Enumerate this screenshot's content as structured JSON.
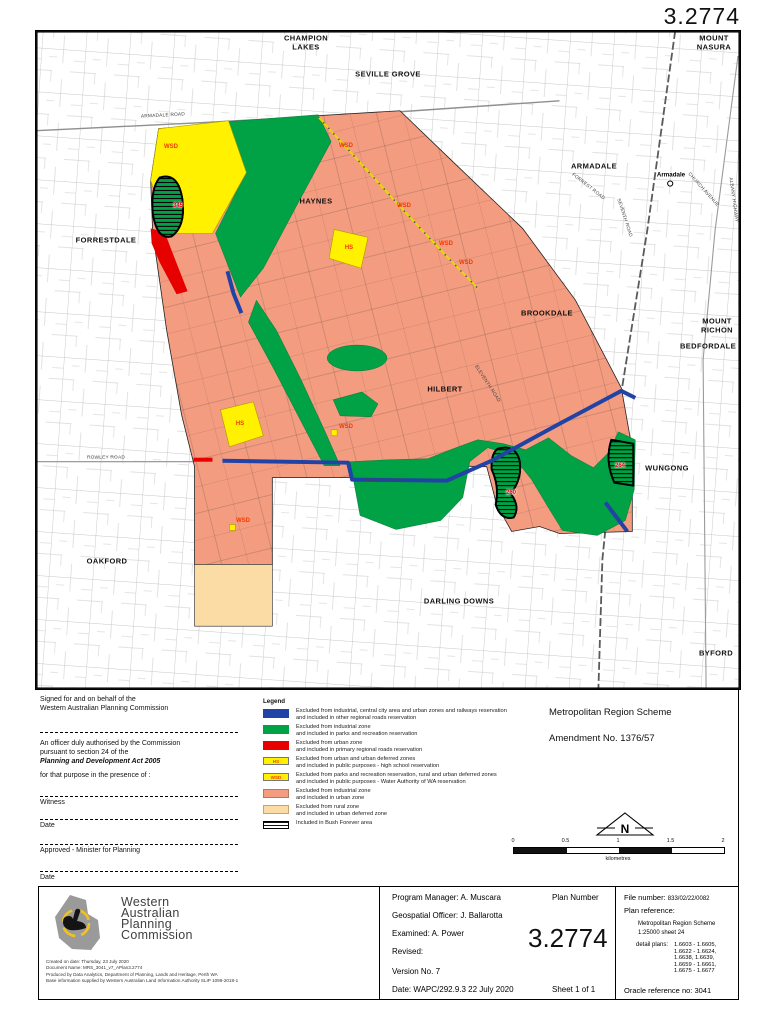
{
  "page": {
    "plan_number": "3.2774"
  },
  "map": {
    "colors": {
      "urban_salmon": "#F49C80",
      "parks_green": "#00A245",
      "reservation_yellow": "#FFF100",
      "roads_blue": "#2143A6",
      "roads_red": "#E60000",
      "urban_deferred_peach": "#FADCA4"
    },
    "suburbs": [
      {
        "t": "CHAMPION",
        "x": 306,
        "y": 38
      },
      {
        "t": "LAKES",
        "x": 306,
        "y": 47
      },
      {
        "t": "SEVILLE GROVE",
        "x": 388,
        "y": 74
      },
      {
        "t": "MOUNT",
        "x": 714,
        "y": 38
      },
      {
        "t": "NASURA",
        "x": 714,
        "y": 47
      },
      {
        "t": "ARMADALE",
        "x": 594,
        "y": 166
      },
      {
        "t": "FORRESTDALE",
        "x": 106,
        "y": 240
      },
      {
        "t": "HAYNES",
        "x": 316,
        "y": 201
      },
      {
        "t": "BROOKDALE",
        "x": 547,
        "y": 313
      },
      {
        "t": "MOUNT",
        "x": 717,
        "y": 321
      },
      {
        "t": "RICHON",
        "x": 717,
        "y": 330
      },
      {
        "t": "BEDFORDALE",
        "x": 708,
        "y": 346
      },
      {
        "t": "HILBERT",
        "x": 445,
        "y": 389
      },
      {
        "t": "WUNGONG",
        "x": 667,
        "y": 468
      },
      {
        "t": "OAKFORD",
        "x": 107,
        "y": 561
      },
      {
        "t": "DARLING DOWNS",
        "x": 459,
        "y": 601
      },
      {
        "t": "BYFORD",
        "x": 716,
        "y": 653
      }
    ],
    "roads": [
      {
        "t": "ARMADALE ROAD",
        "x": 163,
        "y": 116,
        "r": -3
      },
      {
        "t": "ROWLEY ROAD",
        "x": 106,
        "y": 458,
        "r": 0
      },
      {
        "t": "ROWLEY ROAD",
        "x": 385,
        "y": 481,
        "r": 0
      },
      {
        "t": "ELEVENTH ROAD",
        "x": 487,
        "y": 384,
        "r": 57
      },
      {
        "t": "SEVENTH ROAD",
        "x": 624,
        "y": 218,
        "r": 72
      },
      {
        "t": "FORREST ROAD",
        "x": 588,
        "y": 187,
        "r": 38
      },
      {
        "t": "CHURCH AVENUE",
        "x": 703,
        "y": 190,
        "r": 48
      },
      {
        "t": "ALBANY HIGHWAY",
        "x": 733,
        "y": 200,
        "r": 82
      }
    ],
    "reservations": [
      {
        "t": "WSD",
        "x": 171,
        "y": 147
      },
      {
        "t": "WSD",
        "x": 346,
        "y": 146
      },
      {
        "t": "WSD",
        "x": 404,
        "y": 206
      },
      {
        "t": "WSD",
        "x": 446,
        "y": 244
      },
      {
        "t": "WSD",
        "x": 466,
        "y": 263
      },
      {
        "t": "WSD",
        "x": 346,
        "y": 427
      },
      {
        "t": "WSD",
        "x": 243,
        "y": 521
      },
      {
        "t": "HS",
        "x": 349,
        "y": 248
      },
      {
        "t": "HS",
        "x": 240,
        "y": 424
      }
    ],
    "bush_forever": [
      {
        "t": "345",
        "x": 178,
        "y": 206
      },
      {
        "t": "260",
        "x": 511,
        "y": 493
      },
      {
        "t": "264",
        "x": 620,
        "y": 466
      }
    ],
    "station": {
      "t": "Armadale",
      "x": 671,
      "y": 175
    }
  },
  "signature": {
    "line1": "Signed for and on behalf of the",
    "line2": "Western Australian Planning Commission",
    "officer1": "An officer duly authorised by the Commission",
    "officer2": "pursuant to section 24 of the",
    "act": "Planning and Development Act 2005",
    "presence": "for that purpose in the presence of :",
    "witness": "Witness",
    "date1": "Date",
    "approved": "Approved - Minister for Planning",
    "date2": "Date"
  },
  "legend": {
    "title": "Legend",
    "items": [
      {
        "swatch": "blue",
        "lines": [
          "Excluded from industrial, central city area and urban zones and railways reservation",
          "and included in other regional roads reservation"
        ]
      },
      {
        "swatch": "green",
        "lines": [
          "Excluded from industrial zone",
          "and included in parks and recreation reservation"
        ]
      },
      {
        "swatch": "red",
        "lines": [
          "Excluded from urban zone",
          "and included in primary regional roads reservation"
        ]
      },
      {
        "swatch": "hs",
        "swatch_label": "HS",
        "lines": [
          "Excluded from urban and urban deferred zones",
          "and included in public purposes - high school reservation"
        ]
      },
      {
        "swatch": "wsd",
        "swatch_label": "WSD",
        "lines": [
          "Excluded from parks and recreation reservation, rural and urban deferred zones",
          "and included in public purposes - Water Authority of WA reservation"
        ]
      },
      {
        "swatch": "salmon",
        "lines": [
          "Excluded from industrial zone",
          "and included in urban zone"
        ]
      },
      {
        "swatch": "peach",
        "lines": [
          "Excluded from rural zone",
          "and included in urban deferred zone"
        ]
      },
      {
        "swatch": "bush",
        "lines": [
          "Included in Bush Forever area"
        ]
      }
    ]
  },
  "scheme": {
    "title": "Metropolitan Region Scheme",
    "amendment": "Amendment No.  1376/57"
  },
  "north": {
    "label": "N"
  },
  "scale": {
    "ticks": [
      "0",
      "0.5",
      "1",
      "1.5",
      "2"
    ],
    "unit": "kilometres"
  },
  "footer": {
    "left": {
      "org": [
        "Western",
        "Australian",
        "Planning",
        "Commission"
      ],
      "fine_print": [
        "Created on date: Thursday, 23 July 2020",
        "Document Name: MRS_3041_v7_APlan3.2774",
        "Produced by Data Analytics, Department of Planning, Lands and Heritage, Perth WA",
        "Base information supplied by Western Australian Land Information Authority SLIP 1096-2018-1"
      ]
    },
    "middle": {
      "program_manager": "Program Manager:  A. Muscara",
      "plan_number_label": "Plan Number",
      "geospatial": "Geospatial Officer:  J. Ballarotta",
      "examined": "Examined:   A. Power",
      "revised": "Revised:",
      "version": "Version No.   7",
      "date_line": "Date:   WAPC/292.9.3    22 July 2020",
      "sheet": "Sheet 1 of 1"
    },
    "right": {
      "file_number_label": "File number:",
      "file_number": "833/02/22/0082",
      "plan_reference_label": "Plan reference:",
      "plan_reference": [
        "Metropolitan Region Scheme",
        "1:25000 sheet 24"
      ],
      "detail_plans_label": "detail plans:",
      "detail_plans": [
        "1.6603 - 1.6605,",
        "1.6622 - 1.6624,",
        "1.6638, 1.6639,",
        "1.6659 - 1.6661,",
        "1.6675 - 1.6677"
      ],
      "oracle": "Oracle reference no:  3041"
    }
  }
}
